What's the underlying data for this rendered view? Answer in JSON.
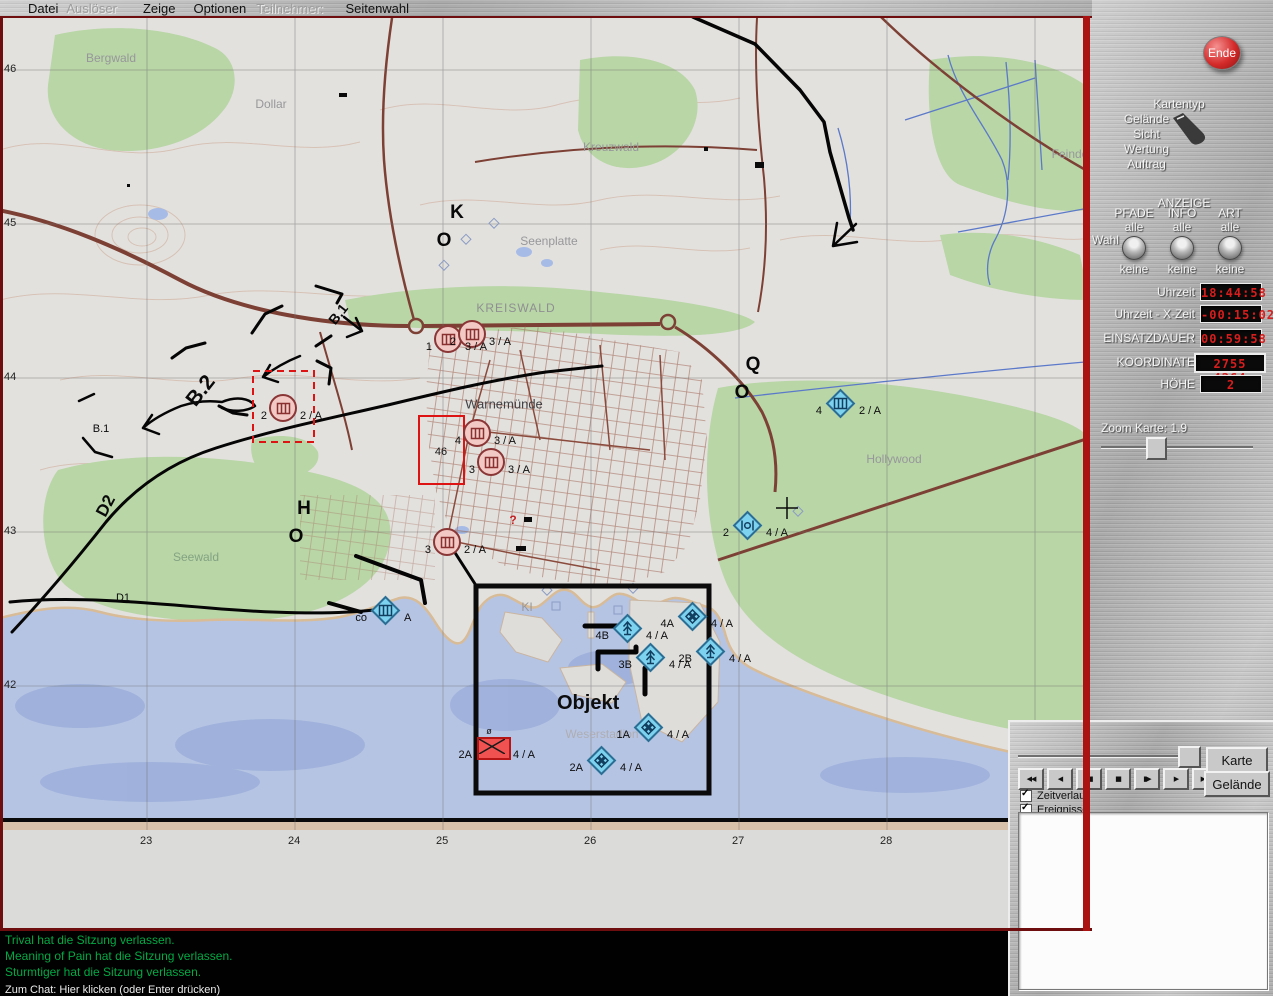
{
  "menu": {
    "items": [
      {
        "label": "Datei",
        "enabled": true
      },
      {
        "label": "Auslöser",
        "enabled": false
      },
      {
        "label": "Zeige",
        "enabled": true
      },
      {
        "label": "Optionen",
        "enabled": true
      },
      {
        "label": "Teilnehmer:",
        "enabled": false
      },
      {
        "label": "Seitenwahl",
        "enabled": true
      }
    ]
  },
  "map": {
    "objekt_label": "Objekt",
    "grid": {
      "x_ticks": [
        {
          "label": "23",
          "x": 147
        },
        {
          "label": "24",
          "x": 295
        },
        {
          "label": "25",
          "x": 443
        },
        {
          "label": "26",
          "x": 591
        },
        {
          "label": "27",
          "x": 739
        },
        {
          "label": "28",
          "x": 887
        }
      ],
      "y_ticks": [
        {
          "label": "46",
          "y": 70
        },
        {
          "label": "45",
          "y": 224
        },
        {
          "label": "44",
          "y": 378
        },
        {
          "label": "43",
          "y": 532
        },
        {
          "label": "42",
          "y": 686
        }
      ]
    },
    "place_labels": [
      {
        "text": "Bergwald",
        "x": 111,
        "y": 58,
        "cls": ""
      },
      {
        "text": "Dollar",
        "x": 271,
        "y": 104,
        "cls": ""
      },
      {
        "text": "Kreuzwald",
        "x": 611,
        "y": 147,
        "cls": ""
      },
      {
        "text": "Seenplatte",
        "x": 549,
        "y": 241,
        "cls": ""
      },
      {
        "text": "KREISWALD",
        "x": 516,
        "y": 308,
        "cls": "place-caps"
      },
      {
        "text": "Warnemünde",
        "x": 504,
        "y": 404,
        "cls": "place-dark"
      },
      {
        "text": "Seewald",
        "x": 196,
        "y": 557,
        "cls": "place-green"
      },
      {
        "text": "Hollywood",
        "x": 894,
        "y": 459,
        "cls": ""
      },
      {
        "text": "Weserstadion",
        "x": 602,
        "y": 734,
        "cls": "place-light"
      },
      {
        "text": "KI",
        "x": 527,
        "y": 607,
        "cls": ""
      },
      {
        "text": "Feinde",
        "x": 1070,
        "y": 154,
        "cls": ""
      }
    ],
    "route_labels": [
      {
        "text": "B.1",
        "x": 338,
        "y": 314,
        "rot": -52,
        "cls": "route-bold",
        "size": 14
      },
      {
        "text": "B.2",
        "x": 201,
        "y": 391,
        "rot": -52,
        "cls": "route-bold",
        "size": 21
      },
      {
        "text": "B.1",
        "x": 101,
        "y": 429,
        "rot": 0,
        "cls": "route-plain",
        "size": 11
      },
      {
        "text": "D2",
        "x": 106,
        "y": 506,
        "rot": -62,
        "cls": "route-bold",
        "size": 17
      },
      {
        "text": "D1",
        "x": 123,
        "y": 598,
        "rot": 0,
        "cls": "route-plain",
        "size": 11
      }
    ],
    "letter_marks": [
      {
        "text": "K",
        "x": 457,
        "y": 213
      },
      {
        "text": "O",
        "x": 444,
        "y": 241
      },
      {
        "text": "Q",
        "x": 753,
        "y": 365
      },
      {
        "text": "O",
        "x": 742,
        "y": 393
      },
      {
        "text": "H",
        "x": 304,
        "y": 509
      },
      {
        "text": "O",
        "x": 296,
        "y": 537
      }
    ],
    "misc_marks": [
      {
        "text": "46",
        "x": 441,
        "y": 452,
        "cls": "blk"
      },
      {
        "text": "ø",
        "x": 489,
        "y": 731,
        "cls": "sm"
      },
      {
        "text": "?",
        "x": 513,
        "y": 520,
        "cls": "redmark"
      }
    ],
    "units": {
      "circles": [
        {
          "x": 448,
          "y": 339,
          "num": "1",
          "label": "3 / A"
        },
        {
          "x": 472,
          "y": 334,
          "num": "2",
          "label": "3 / A"
        },
        {
          "x": 283,
          "y": 408,
          "num": "2",
          "label": "2 / A"
        },
        {
          "x": 477,
          "y": 433,
          "num": "4",
          "label": "3 / A"
        },
        {
          "x": 491,
          "y": 462,
          "num": "3",
          "label": "3 / A"
        },
        {
          "x": 447,
          "y": 542,
          "num": "3",
          "label": "2 / A"
        }
      ],
      "diamonds": [
        {
          "x": 840,
          "y": 403,
          "num": "4",
          "label": "2 / A",
          "glyph": "ladder"
        },
        {
          "x": 747,
          "y": 525,
          "num": "2",
          "label": "4 / A",
          "glyph": "cbars"
        },
        {
          "x": 385,
          "y": 610,
          "num": "co",
          "label": "A",
          "glyph": "ladder"
        },
        {
          "x": 627,
          "y": 628,
          "num": "4B",
          "label": "4 / A",
          "glyph": "anchor"
        },
        {
          "x": 650,
          "y": 657,
          "num": "3B",
          "label": "4 / A",
          "glyph": "anchor"
        },
        {
          "x": 692,
          "y": 616,
          "num": "4A",
          "label": "4 / A",
          "glyph": "quad"
        },
        {
          "x": 710,
          "y": 651,
          "num": "2B",
          "label": "4 / A",
          "glyph": "anchor"
        },
        {
          "x": 648,
          "y": 727,
          "num": "1A",
          "label": "4 / A",
          "glyph": "quad"
        },
        {
          "x": 601,
          "y": 760,
          "num": "2A",
          "label": "4 / A",
          "glyph": "quad"
        }
      ],
      "enemy": [
        {
          "x": 492,
          "y": 747,
          "num": "2A",
          "label": "4 / A"
        }
      ]
    }
  },
  "sidebar": {
    "ende_label": "Ende",
    "kartentyp": {
      "title": "Kartentyp",
      "options": [
        "Gelände",
        "Sicht",
        "Wertung",
        "Auftrag"
      ],
      "selected": "Gelände"
    },
    "anzeige": {
      "title": "ANZEIGE",
      "wahl_label": "Wahl",
      "columns": [
        {
          "name": "PFADE",
          "top": "alle",
          "bottom": "keine"
        },
        {
          "name": "INFO",
          "top": "alle",
          "bottom": "keine"
        },
        {
          "name": "ART",
          "top": "alle",
          "bottom": "keine"
        }
      ]
    },
    "readouts": [
      {
        "label": "Uhrzeit",
        "value": "18:44:58"
      },
      {
        "label": "Uhrzeit - X-Zeit",
        "value": "-00:15:02"
      },
      {
        "label": "EINSATZDAUER",
        "value": "00:59:58"
      },
      {
        "label": "KOORDINATE",
        "value": "2755 4264",
        "wide": true
      },
      {
        "label": "HÖHE",
        "value": "2"
      }
    ],
    "zoom_label": "Zoom Karte:  1.9"
  },
  "playback": {
    "buttons": [
      {
        "name": "rewind",
        "glyph": "◀◀"
      },
      {
        "name": "play-reverse",
        "glyph": "◀"
      },
      {
        "name": "step-back",
        "glyph": "◀▮"
      },
      {
        "name": "stop",
        "glyph": "■"
      },
      {
        "name": "step-forward",
        "glyph": "▮▶"
      },
      {
        "name": "play",
        "glyph": "▶"
      },
      {
        "name": "fast-forward",
        "glyph": "▶▶"
      }
    ],
    "checkboxes": [
      {
        "label": "Zeitverlauf",
        "checked": true
      },
      {
        "label": "Ereignisse",
        "checked": true
      }
    ],
    "side_buttons": [
      "Karte",
      "Gelände"
    ]
  },
  "chat": {
    "messages": [
      "Trival hat die Sitzung verlassen.",
      "Meaning of Pain hat die Sitzung verlassen.",
      "Sturmtiger hat die Sitzung verlassen."
    ],
    "prompt": "Zum Chat: Hier klicken (oder Enter drücken)",
    "message_color": "#00aa44"
  },
  "colors": {
    "led_text": "#d81d1d",
    "map_marking_red": "#dd1212",
    "water": "#b6c4e4",
    "forest": "#b9d6a7",
    "road": "#7d4034"
  }
}
